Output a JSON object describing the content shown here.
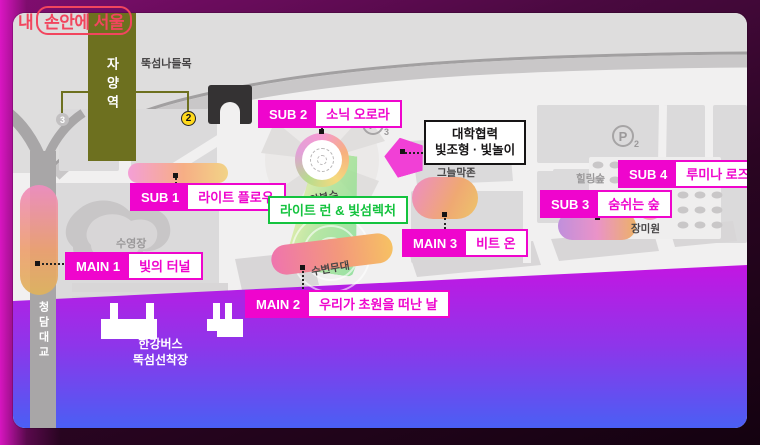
{
  "colors": {
    "accent_magenta": "#ef05cd",
    "accent_green": "#14c33e",
    "logo_red": "#f2455e",
    "station_olive": "#6d701f",
    "water_top": "#c316e2",
    "water_bottom": "#4a5ff4"
  },
  "logo": {
    "prefix": "내",
    "boxed": "손안에 서울"
  },
  "venues": {
    "sub1": {
      "tag": "SUB 1",
      "name": "라이트 플로우"
    },
    "sub2": {
      "tag": "SUB 2",
      "name": "소닉 오로라"
    },
    "sub3": {
      "tag": "SUB 3",
      "name": "숨쉬는 숲"
    },
    "sub4": {
      "tag": "SUB 4",
      "name": "루미나 로즈"
    },
    "main1": {
      "tag": "MAIN 1",
      "name": "빛의 터널"
    },
    "main2": {
      "tag": "MAIN 2",
      "name": "우리가 초원을 떠난 날"
    },
    "main3": {
      "tag": "MAIN 3",
      "name": "비트 온"
    }
  },
  "callouts": {
    "univ_line1": "대학협력",
    "univ_line2": "빛조형 · 빛놀이",
    "light_run": "라이트 런 & 빛섬렉처"
  },
  "map_labels": {
    "station": "자양역",
    "exit2": "2",
    "exit3": "3",
    "interchange": "뚝섬나들목",
    "parking_letter": "P",
    "parking2_num": "2",
    "parking3_num": "3",
    "music_fountain": "음악분수",
    "pool": "수영장",
    "stage": "수변무대",
    "shade_zone": "그늘막존",
    "healing_forest": "힐링숲",
    "rose_garden": "장미원",
    "bridge": "청담대교",
    "ferry_line1": "한강버스",
    "ferry_line2": "뚝섬선착장"
  }
}
